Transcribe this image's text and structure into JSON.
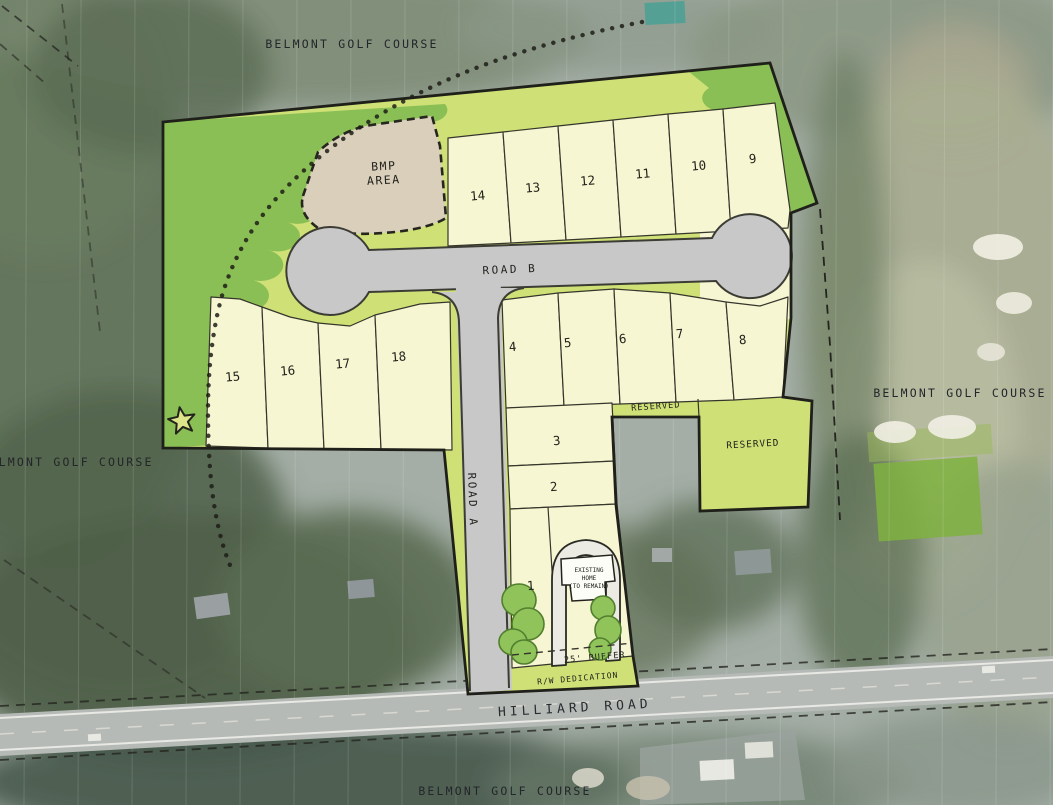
{
  "title": "Belmont subdivision site plan",
  "colors": {
    "open_space": "#8abf55",
    "buffer": "#cfe076",
    "lot": "#f7f6d2",
    "bmp_area": "#d9cfbb",
    "road": "#c8c8c9",
    "tree": "#90c35a",
    "tree_edge": "#527f2e",
    "line": "#35352c",
    "label": "#23231d"
  },
  "labels": {
    "golf_top": "BELMONT GOLF COURSE",
    "golf_left": "BELMONT GOLF COURSE",
    "golf_right": "BELMONT GOLF COURSE",
    "golf_bottom": "BELMONT GOLF COURSE",
    "hilliard_road": "HILLIARD ROAD",
    "road_a": "ROAD A",
    "road_b": "ROAD B",
    "bmp_line1": "BMP",
    "bmp_line2": "AREA",
    "reserved_strip": "RESERVED",
    "reserved_block": "RESERVED",
    "buffer_25": "25' BUFFER",
    "rw_dedication": "R/W DEDICATION",
    "home_line1": "EXISTING",
    "home_line2": "HOME",
    "home_line3": "(TO REMAIN)"
  },
  "lots": {
    "1": "1",
    "2": "2",
    "3": "3",
    "4": "4",
    "5": "5",
    "6": "6",
    "7": "7",
    "8": "8",
    "9": "9",
    "10": "10",
    "11": "11",
    "12": "12",
    "13": "13",
    "14": "14",
    "15": "15",
    "16": "16",
    "17": "17",
    "18": "18"
  }
}
